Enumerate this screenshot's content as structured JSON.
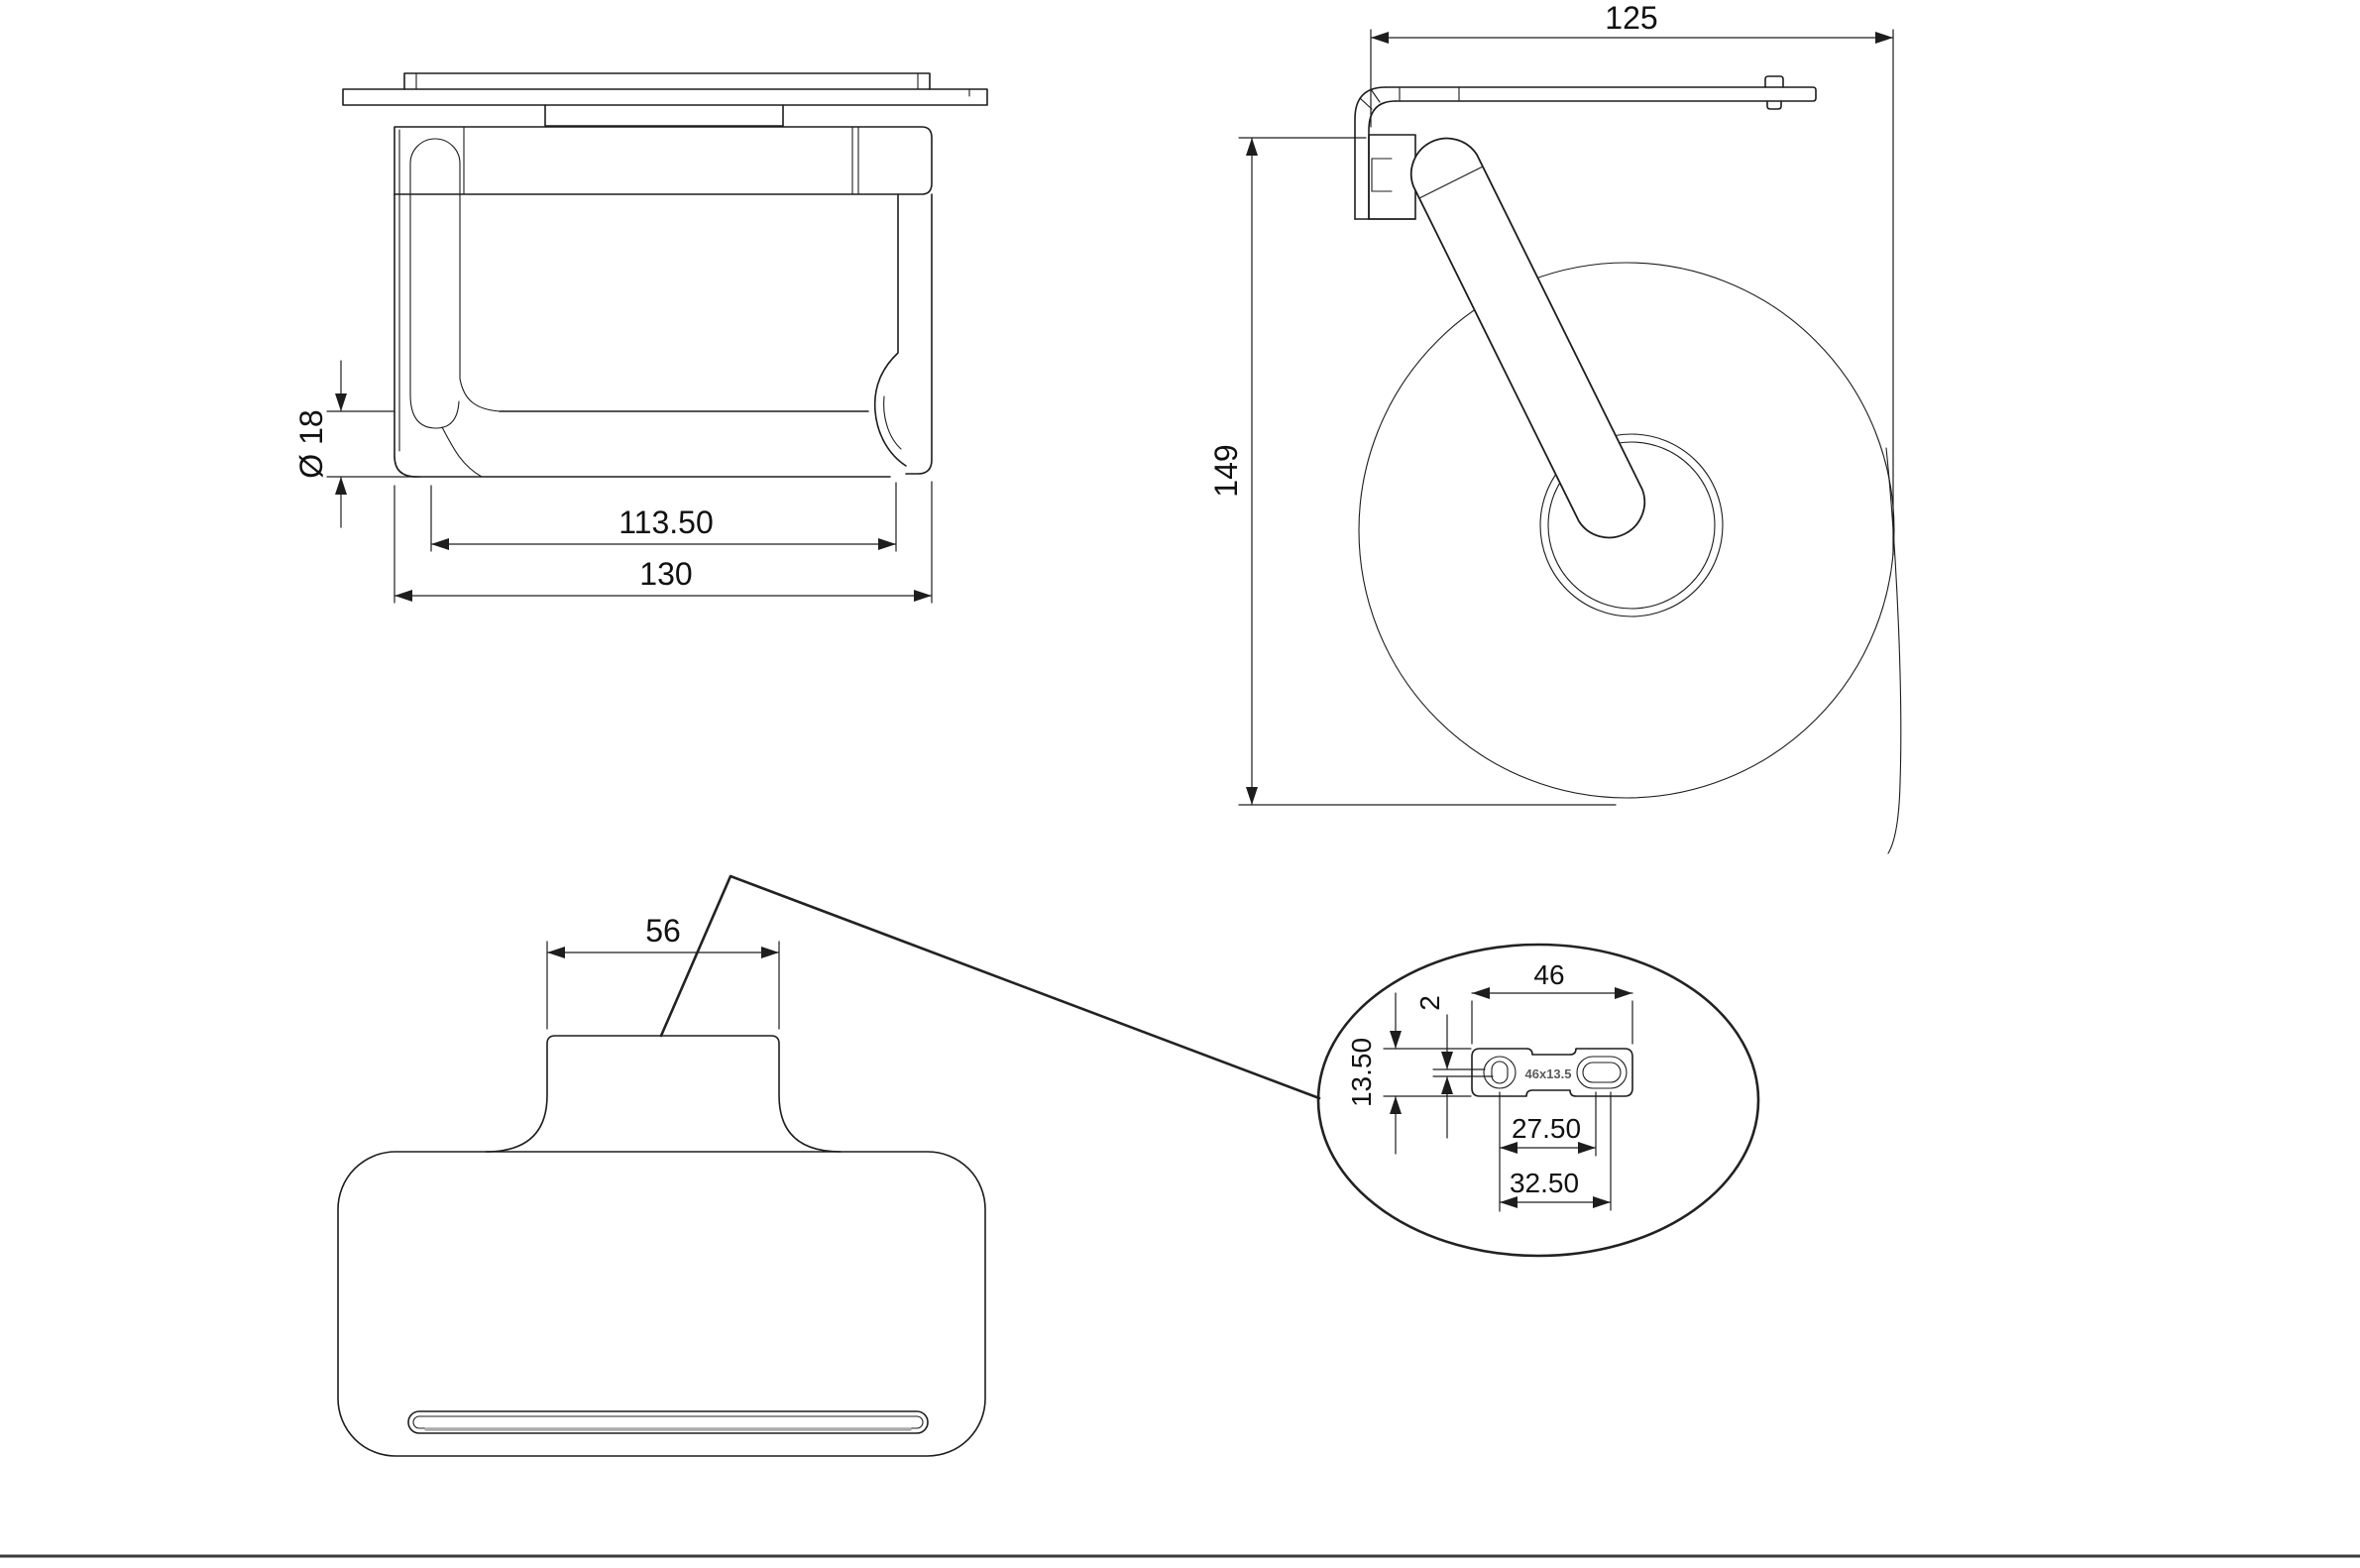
{
  "drawing_title": "toilet roll holder with shelf - dimensional drawing",
  "views": {
    "front": {
      "dims": {
        "bar_diameter": "Ø 18",
        "roller_inner_width": "113.50",
        "overall_width": "130"
      }
    },
    "side": {
      "dims": {
        "overall_depth": "125",
        "overall_height": "149"
      }
    },
    "top": {
      "dims": {
        "mount_tab_width": "56"
      }
    },
    "detail": {
      "dims": {
        "plate_width": "46",
        "rim_thickness": "2",
        "plate_height": "13.50",
        "hole_pitch_inner": "27.50",
        "hole_pitch_outer": "32.50"
      },
      "plate_stamp": "46x13.5"
    }
  },
  "style": {
    "line_color": "#1d1d1d",
    "background": "#ffffff"
  }
}
